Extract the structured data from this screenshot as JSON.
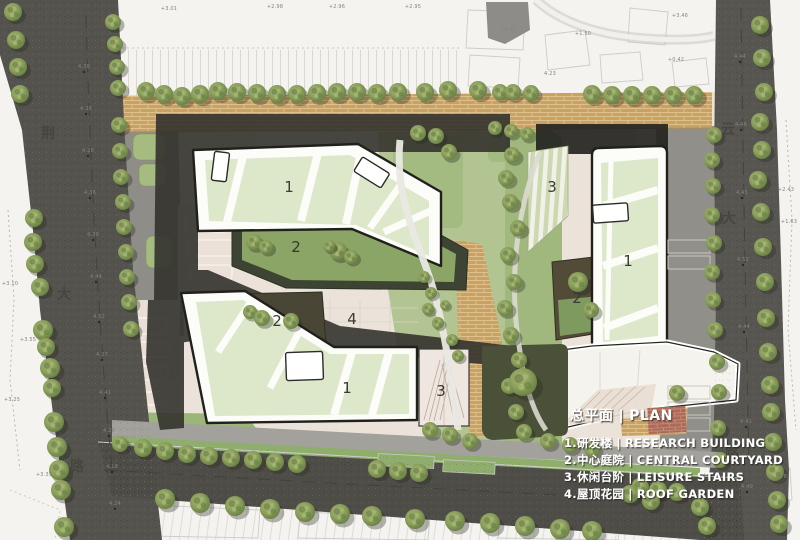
{
  "legend": {
    "title_zh": "总平面",
    "sep": "|",
    "title_en": "PLAN",
    "items": [
      {
        "num": "1.",
        "zh": "研发楼",
        "en": "RESEARCH BUILDING"
      },
      {
        "num": "2.",
        "zh": "中心庭院",
        "en": "CENTRAL COURTYARD"
      },
      {
        "num": "3.",
        "zh": "休闲台阶",
        "en": "LEISURE STAIRS"
      },
      {
        "num": "4.",
        "zh": "屋顶花园",
        "en": "ROOF GARDEN"
      }
    ]
  },
  "roads": {
    "left_name": [
      "荆",
      "大",
      "路"
    ],
    "right_name": [
      "云",
      "大",
      "路"
    ]
  },
  "plan_labels": {
    "research_building": "1",
    "central_courtyard": "2",
    "leisure_stairs": "3",
    "roof_garden": "4"
  },
  "annotations": {
    "top": [
      "+3.01",
      "+2.98",
      "+2.96",
      "+2.95",
      "+2.42",
      "+1.50",
      "+3.46",
      "+0.42",
      "4.23"
    ],
    "left_context": [
      "+3.10",
      "+3.55",
      "+3.25",
      "+3.35"
    ],
    "right_context": [
      "+2.43",
      "+1.63",
      "+2.78"
    ],
    "left_road": [
      "4.38",
      "4.36",
      "4.26",
      "4.36",
      "4.39",
      "4.44",
      "4.52",
      "4.27",
      "4.41",
      "4.28",
      "4.18",
      "4.24"
    ],
    "right_road": [
      "4.44",
      "4.46",
      "4.45",
      "4.52",
      "4.44",
      "4.41",
      "4.49"
    ]
  },
  "colors": {
    "asphalt": "#55534d",
    "brick_paving": "#c9a164",
    "red_brick": "#ad6a58",
    "building_white": "#fcfcf9",
    "roof_green": "#dde8cb",
    "lawn_green": "#8aa566",
    "site_green": "#b2c491",
    "dark_olive": "#4b5139",
    "shadow": "#34332d",
    "tree_green": "#8aa05b",
    "legend_text": "#ffffff"
  }
}
